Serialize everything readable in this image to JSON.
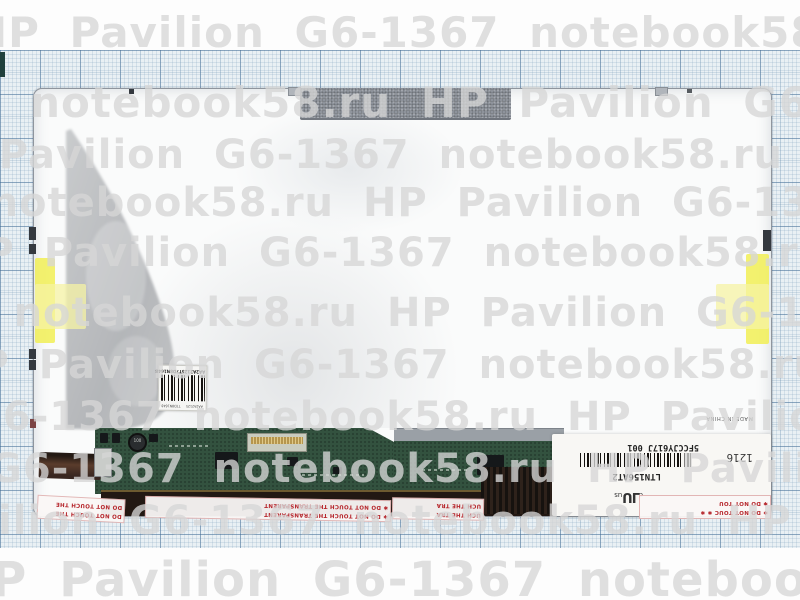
{
  "photo": {
    "subject": "Laptop LCD screen rear panel on graph paper",
    "colors": {
      "grid_paper": "#e9f0f4",
      "grid_line": "#3e6892",
      "panel": "#fafbfb",
      "foam_tab": "#8e939b",
      "yellow_tape": "#f1ee55",
      "pcb_green": "#33523f",
      "warning_red": "#b5242a",
      "watermark_gray": "#d6d6d6"
    }
  },
  "watermark": {
    "brand_text": "HP Pavilion G6-1367",
    "site_text": "notebook58.ru",
    "sequence": "HP Pavilion G6-1367   notebook58.ru   "
  },
  "barcode_label": {
    "main_text": "AA2A2125T7D8N1648",
    "sub_left": "AA2A2125",
    "sub_right": "T7D8N1648"
  },
  "info_label": {
    "model": "LTN156AT2",
    "serial": "5FCCJY617J 001",
    "week_code": "1216",
    "cert_prefix": "c",
    "cert_mark": "UL",
    "cert_suffix": "us",
    "made_in": "MADE IN CHINA"
  },
  "warning_tape": {
    "full_text": "DO NOT TOUCH THE TRANSPARENT",
    "segments": [
      {
        "lines": [
          "DO NOT TOUCH THE",
          "DO NOT TOUCH THE"
        ]
      },
      {
        "lines": [
          "✱ DO NOT TOUCH THE TRANSPARENT",
          "✱ DO NOT TOUCH THE TRANSPARENT"
        ]
      },
      {
        "lines": [
          "UCH THE TRA",
          "UCH THE TRA"
        ]
      },
      {
        "lines": [
          "✱ DO NOT TOUC  ✱  ✱",
          "✱ DO NOT TOU"
        ]
      }
    ]
  }
}
